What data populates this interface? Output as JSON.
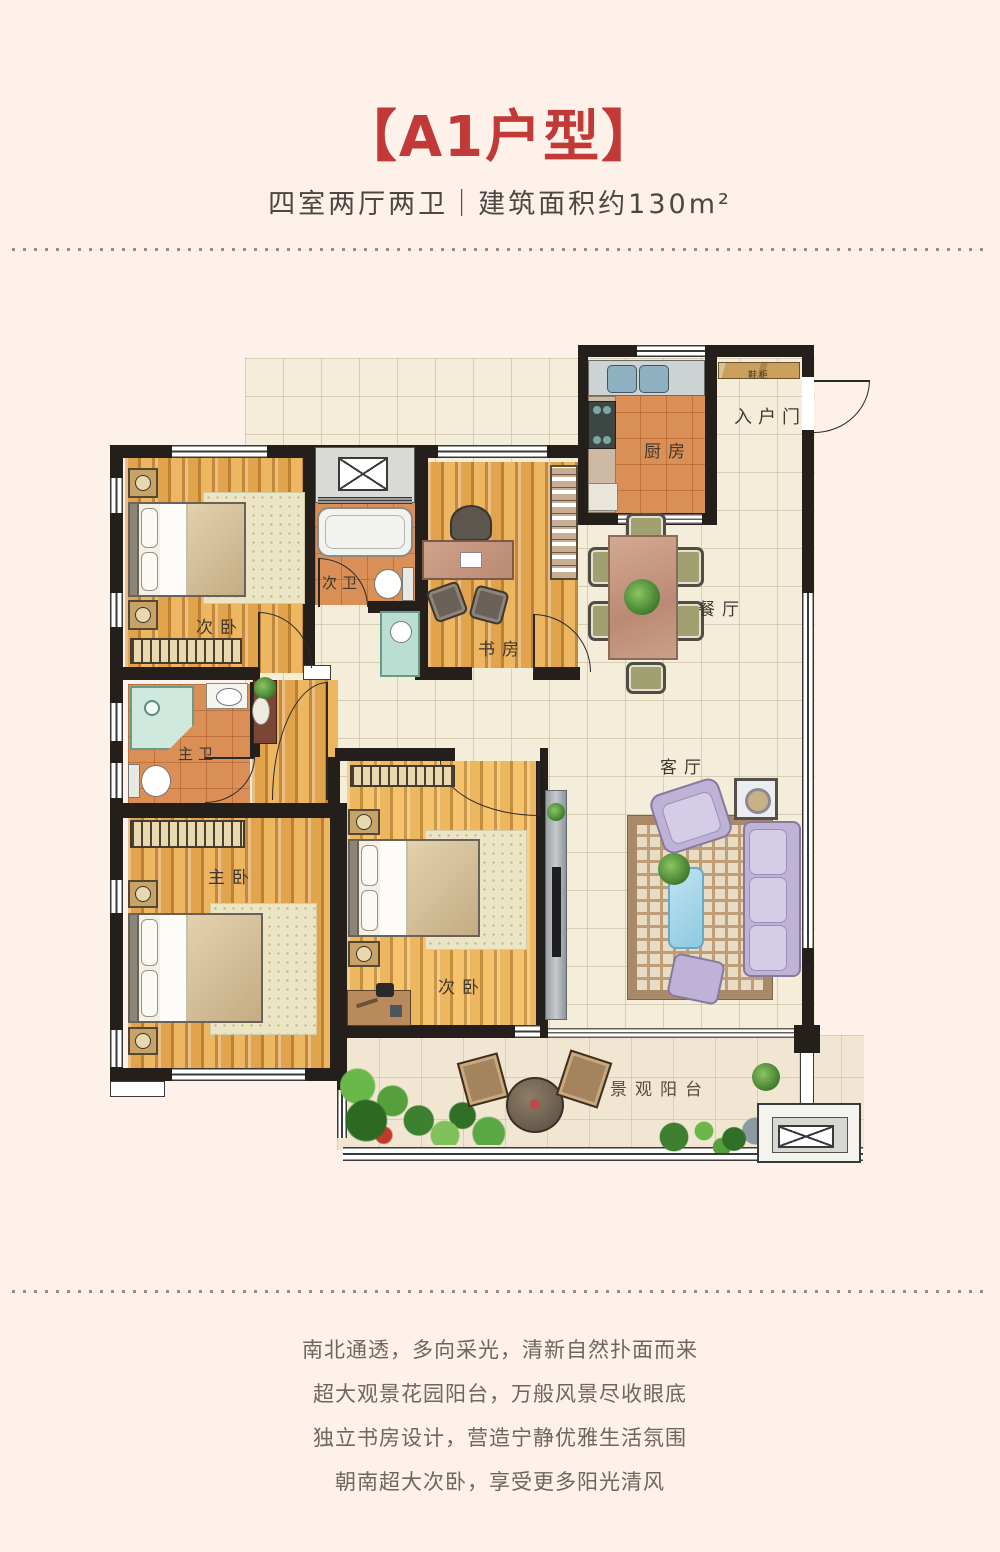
{
  "header": {
    "title": "【A1户型】",
    "subtitle": "四室两厅两卫｜建筑面积约130m²"
  },
  "rooms": {
    "bedroom_top": "次卧",
    "bath_second": "次卫",
    "study": "书房",
    "kitchen": "厨房",
    "entry": "入户门",
    "shoe_cabinet": "鞋柜",
    "dining": "餐厅",
    "living": "客厅",
    "bath_master": "主卫",
    "bedroom_master": "主卧",
    "bedroom_bottom": "次卧",
    "balcony": "景观阳台"
  },
  "description": {
    "line1": "南北通透，多向采光，清新自然扑面而来",
    "line2": "超大观景花园阳台，万般风景尽收眼底",
    "line3": "独立书房设计，营造宁静优雅生活氛围",
    "line4": "朝南超大次卧，享受更多阳光清风"
  },
  "colors": {
    "accent": "#c13a38",
    "background": "#fdf1e9",
    "wall": "#241f1b"
  }
}
